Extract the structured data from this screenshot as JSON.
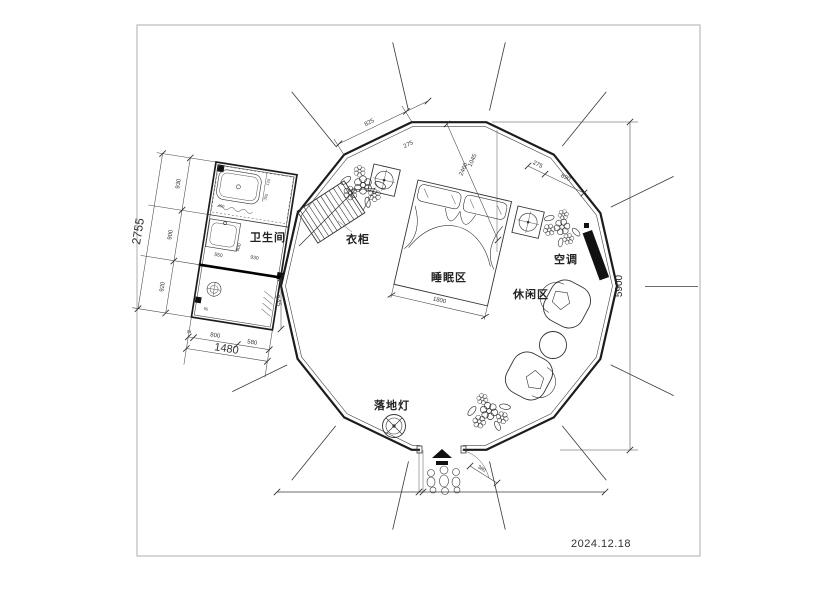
{
  "plan": {
    "labels": {
      "bathroom": "卫生间",
      "wardrobe": "衣柜",
      "sleeping_area": "睡眠区",
      "leisure_area": "休闲区",
      "air_conditioner": "空调",
      "floor_lamp": "落地灯"
    },
    "dims": {
      "total_height": "5900",
      "bath_total_w": "1480",
      "bath_total_h": "2755",
      "seg_930": "930",
      "seg_900": "900",
      "seg_920": "920",
      "seg_94": "94",
      "seg_800": "800",
      "seg_580": "580",
      "wall_825": "825",
      "off_275a": "275",
      "diag_2460": "2460",
      "diag_1045": "1045",
      "off_275b": "275",
      "wall_690": "690",
      "bed_1800": "1800",
      "door_380": "380",
      "corr_945": "945",
      "sink_550": "550",
      "in_900": "900",
      "in_930": "930",
      "tub_400": "400",
      "tub_120": "120",
      "tub_350": "350",
      "small_95": "95"
    },
    "colors": {
      "wall": "#1c1c1c",
      "ac_unit": "#111111",
      "frame": "#bbbbbb"
    }
  },
  "footer": {
    "date": "2024.12.18"
  }
}
